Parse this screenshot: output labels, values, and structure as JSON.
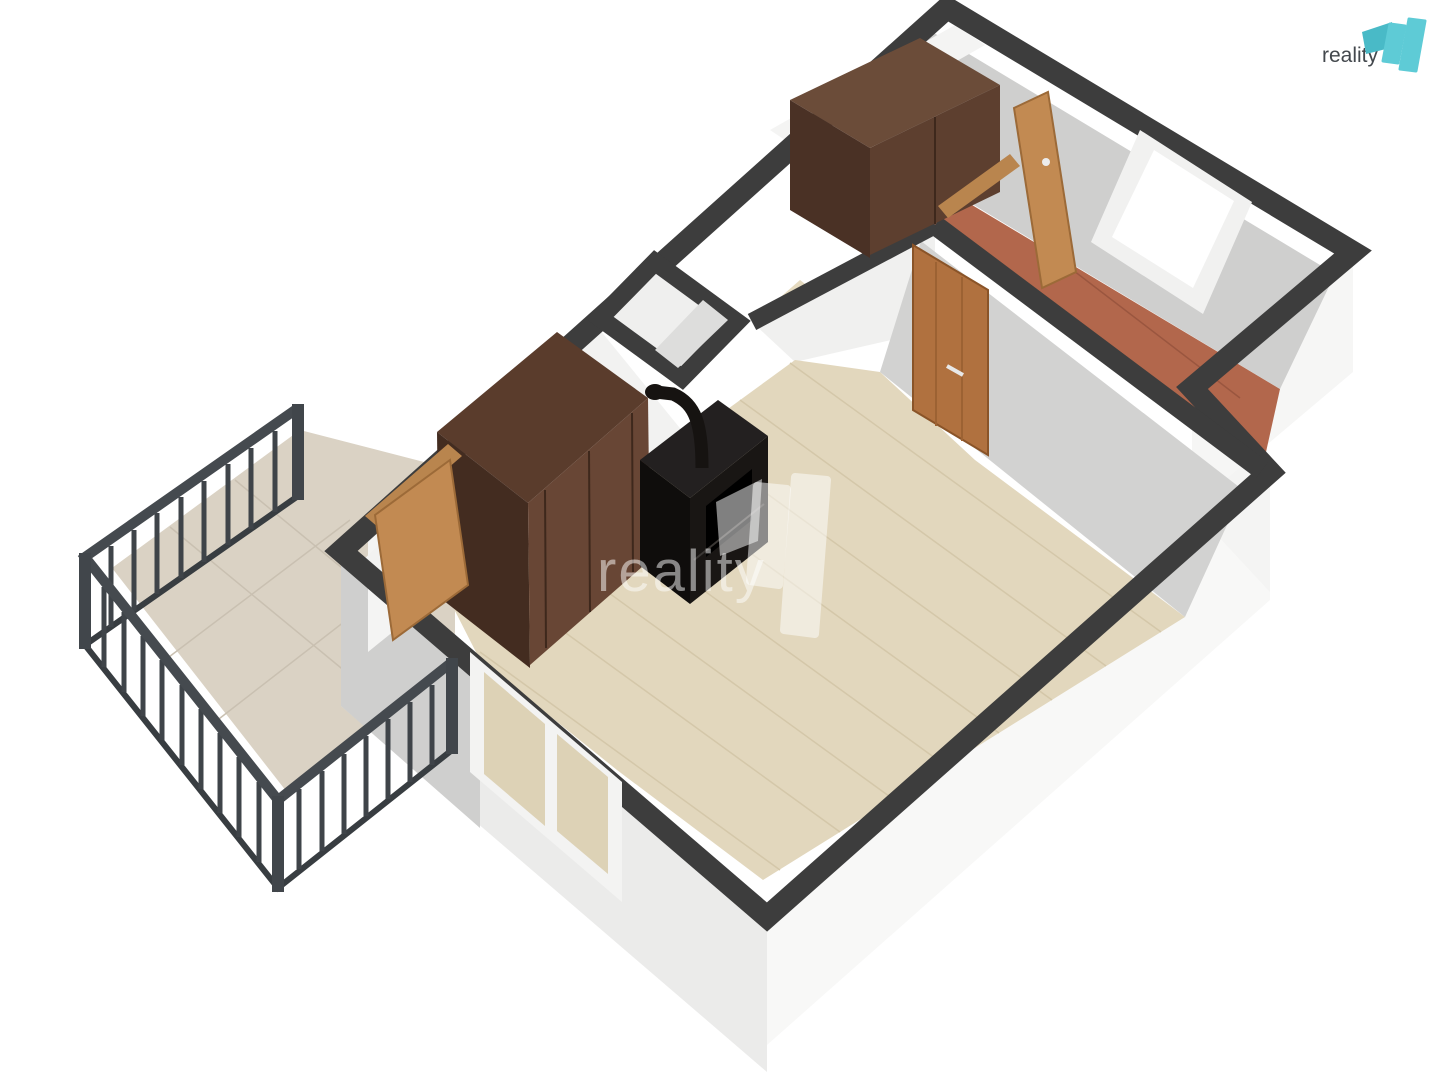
{
  "page": {
    "background": "#ffffff",
    "width": 1440,
    "height": 1080
  },
  "logo": {
    "text": "reality",
    "text_color": "#43484d",
    "teal": "#5ecbd6",
    "teal_dark": "#49bac7"
  },
  "watermark": {
    "text": "reality",
    "color": "#ffffff",
    "opacity": 0.5
  },
  "palette": {
    "wall_top": "#3d3d3d",
    "wall_int_bright": "#f2f2f1",
    "wall_int_gray": "#d2d2d1",
    "ext_white": "#f8f8f7",
    "ext_gray": "#cfcfce",
    "floor_wood": "#e2d7bd",
    "floor_terracotta": "#b2674c",
    "balcony_tile": "#dad2c4",
    "railing": "#42474b",
    "wardrobe": "#5d3f2f",
    "stove": "#161311",
    "door_wood": "#c28a52",
    "window_frame": "#f3f3f2"
  },
  "scene": {
    "width": 1440,
    "height": 1080,
    "layers": [
      {
        "name": "balcony-floor",
        "type": "polygon",
        "fill": "#dad2c4",
        "points": "300,430 112,568 290,796 455,664 455,470"
      },
      {
        "name": "balcony-tile-line",
        "type": "lines",
        "stroke": "#c9c0b1",
        "width": 1.5,
        "segments": [
          [
            170,
            527,
            352,
            677
          ],
          [
            235,
            480,
            415,
            628
          ],
          [
            165,
            660,
            350,
            520
          ],
          [
            215,
            722,
            398,
            580
          ]
        ]
      },
      {
        "name": "exterior-wall-sw",
        "type": "polygon",
        "fill": "#ebebea",
        "points": "341,551 767,917 767,1072 341,706"
      },
      {
        "name": "exterior-wall-sw-shade",
        "type": "polygon",
        "fill": "#cfcfce",
        "points": "341,551 480,670 480,828 341,706"
      },
      {
        "name": "exterior-wall-se",
        "type": "polygon",
        "fill": "#f8f8f7",
        "points": "767,917 1270,472 1270,600 767,1045"
      },
      {
        "name": "exterior-wall-step",
        "type": "polygon",
        "fill": "#f4f4f3",
        "points": "1192,388 1270,472 1270,592 1192,508"
      },
      {
        "name": "exterior-wall-rightroom",
        "type": "polygon",
        "fill": "#f6f6f5",
        "points": "1353,252 1192,388 1192,508 1353,372"
      },
      {
        "name": "exterior-stub-balcony-door",
        "type": "polygon",
        "fill": "#f4f4f3",
        "points": "452,462 368,530 368,652 452,584"
      },
      {
        "name": "hall-floor",
        "type": "polygon",
        "fill": "#b2674c",
        "points": "880,150 1280,389 1262,470 932,228"
      },
      {
        "name": "hall-tile-line",
        "type": "lines",
        "stroke": "#9a563f",
        "width": 1.5,
        "segments": [
          [
            1010,
            222,
            1240,
            398
          ],
          [
            1075,
            175,
            1278,
            330
          ]
        ]
      },
      {
        "name": "ne-wall-interior-face",
        "type": "polygon",
        "fill": "#cfcfce",
        "points": "929,30 1335,274 1280,389 874,145"
      },
      {
        "name": "bedroom-nw-wall-face",
        "type": "polygon",
        "fill": "#f4f4f3",
        "points": "770,130 955,25 985,45 800,150"
      },
      {
        "name": "bedroom-floor",
        "type": "polygon",
        "fill": "#e5dabf",
        "points": "752,322 800,352 845,315 800,280"
      },
      {
        "name": "bedroom-se-wall-face",
        "type": "polygon",
        "fill": "#f0f0ef",
        "points": "752,322 935,225 935,330 795,362"
      },
      {
        "name": "main-room-floor",
        "type": "polygon",
        "fill": "#e2d7bd",
        "points": "452,605 560,523 688,438 795,360 880,372 975,460 1113,563 1185,617 763,880 617,770 480,660"
      },
      {
        "name": "floor-plank-line",
        "type": "lines",
        "stroke": "#d4c7a9",
        "width": 1.5,
        "segments": [
          [
            480,
            652,
            780,
            870
          ],
          [
            490,
            578,
            840,
            832
          ],
          [
            540,
            543,
            893,
            799
          ],
          [
            590,
            508,
            946,
            766
          ],
          [
            640,
            473,
            999,
            733
          ],
          [
            690,
            438,
            1052,
            700
          ],
          [
            740,
            400,
            1106,
            666
          ],
          [
            790,
            363,
            1161,
            632
          ]
        ]
      },
      {
        "name": "nw-wall-interior-face",
        "type": "polygon",
        "fill": "#f2f2f1",
        "points": "357,566 600,330 688,438 452,605"
      },
      {
        "name": "mainhall-wall-face",
        "type": "polygon",
        "fill": "#d2d2d1",
        "points": "921,241 1243,490 1185,617 880,372"
      },
      {
        "name": "wall-top-perimeter",
        "type": "path",
        "stroke": "#3d3d3d",
        "width": 22,
        "fill": "none",
        "d": "M341,551 L947,8 L1353,252 L1192,388 L1270,472 L767,917 Z"
      },
      {
        "name": "wall-top-mainhall",
        "type": "lines",
        "stroke": "#3d3d3d",
        "width": 20,
        "segments": [
          [
            935,
            225,
            1262,
            470
          ]
        ]
      },
      {
        "name": "wall-top-bedroom-se",
        "type": "lines",
        "stroke": "#3d3d3d",
        "width": 18,
        "segments": [
          [
            752,
            322,
            935,
            225
          ]
        ]
      },
      {
        "name": "chimney-niche-ring",
        "type": "path",
        "stroke": "#3d3d3d",
        "width": 18,
        "fill": "#efefee",
        "d": "M600,318 L655,262 L737,322 L682,378 Z"
      },
      {
        "name": "chimney-niche-shade",
        "type": "polygon",
        "fill": "#dddddc",
        "points": "655,350 703,300 728,320 678,368"
      },
      {
        "name": "window-sw-frame",
        "type": "polygon",
        "fill": "#f3f3f2",
        "points": "470,652 622,782 622,902 470,772"
      },
      {
        "name": "window-sw-glass-left",
        "type": "polygon",
        "fill": "#ddd2b6",
        "points": "484,672 545,724 545,826 484,774"
      },
      {
        "name": "window-sw-glass-right",
        "type": "polygon",
        "fill": "#ddd2b6",
        "points": "557,734 608,777 608,874 557,831"
      },
      {
        "name": "window-ne-frame",
        "type": "polygon",
        "fill": "#f1f1f0",
        "points": "1140,130 1252,202 1203,314 1091,242"
      },
      {
        "name": "window-ne-glass",
        "type": "polygon",
        "fill": "#ffffff",
        "points": "1154,150 1234,201 1193,288 1112,237"
      },
      {
        "name": "wardrobe-livingroom-top",
        "type": "polygon",
        "fill": "#5a3c2c",
        "points": "437,432 557,332 648,398 528,503"
      },
      {
        "name": "wardrobe-livingroom-side",
        "type": "polygon",
        "fill": "#432c20",
        "points": "437,432 528,503 530,668 439,597"
      },
      {
        "name": "wardrobe-livingroom-front",
        "type": "polygon",
        "fill": "#684635",
        "points": "528,503 648,398 650,560 530,665"
      },
      {
        "name": "wardrobe-livingroom-doorline",
        "type": "lines",
        "stroke": "#3e281c",
        "width": 2,
        "segments": [
          [
            589,
            451,
            590,
            612
          ],
          [
            545,
            490,
            546,
            648
          ],
          [
            632,
            413,
            633,
            572
          ]
        ]
      },
      {
        "name": "stove-side",
        "type": "polygon",
        "fill": "#0f0d0c",
        "points": "640,460 690,498 690,604 640,566"
      },
      {
        "name": "stove-front",
        "type": "polygon",
        "fill": "#191614",
        "points": "690,498 768,436 768,542 690,604"
      },
      {
        "name": "stove-top",
        "type": "polygon",
        "fill": "#232020",
        "points": "640,460 718,400 768,436 690,498"
      },
      {
        "name": "stove-door",
        "type": "polygon",
        "fill": "#000000",
        "points": "706,506 752,469 752,520 706,557"
      },
      {
        "name": "stove-highlight",
        "type": "lines",
        "stroke": "#3a3734",
        "width": 2,
        "segments": [
          [
            694,
            560,
            764,
            504
          ]
        ]
      },
      {
        "name": "stove-pipe",
        "type": "path",
        "stroke": "#161311",
        "width": 13,
        "fill": "none",
        "d": "M702,468 C702,425 696,404 673,394 L656,392"
      },
      {
        "name": "stove-pipe-flange",
        "type": "ellipse",
        "fill": "#161311",
        "cx": 655,
        "cy": 392,
        "rx": 10,
        "ry": 8
      },
      {
        "name": "wardrobe-bedroom-top",
        "type": "polygon",
        "fill": "#6b4c39",
        "points": "790,100 920,38 1000,85 870,148"
      },
      {
        "name": "wardrobe-bedroom-side",
        "type": "polygon",
        "fill": "#4a3125",
        "points": "790,100 870,148 870,258 790,210"
      },
      {
        "name": "wardrobe-bedroom-front",
        "type": "polygon",
        "fill": "#5d3f2f",
        "points": "870,148 1000,85 1000,192 870,255"
      },
      {
        "name": "wardrobe-bedroom-doorline",
        "type": "lines",
        "stroke": "#3e281c",
        "width": 2,
        "segments": [
          [
            935,
            117,
            935,
            224
          ]
        ]
      },
      {
        "name": "balcony-door-lintel",
        "type": "polygon",
        "fill": "#b9854e",
        "points": "365,516 448,444 462,456 379,528"
      },
      {
        "name": "balcony-door-leaf",
        "type": "polygon",
        "fill": "#c28a52",
        "stroke": "#9c6a38",
        "width": 2,
        "points": "375,515 450,460 468,585 393,640"
      },
      {
        "name": "door-livingroom-hall",
        "type": "polygon",
        "fill": "#b0713f",
        "stroke": "#8a5428",
        "width": 2,
        "points": "913,245 988,290 988,455 913,410"
      },
      {
        "name": "door-livingroom-hall-grooves",
        "type": "lines",
        "stroke": "#9c6233",
        "width": 2,
        "segments": [
          [
            936,
            262,
            936,
            426
          ],
          [
            962,
            277,
            962,
            441
          ]
        ]
      },
      {
        "name": "door-livingroom-hall-handle",
        "type": "lines",
        "stroke": "#e8e8e8",
        "width": 4,
        "segments": [
          [
            947,
            366,
            963,
            375
          ]
        ]
      },
      {
        "name": "bedroom-door-lintel",
        "type": "polygon",
        "fill": "#b9854e",
        "points": "938,206 1010,154 1020,166 948,218"
      },
      {
        "name": "bedroom-door-leaf",
        "type": "polygon",
        "fill": "#c28a52",
        "stroke": "#9c6a38",
        "width": 2,
        "points": "1014,108 1048,92 1076,272 1042,288"
      },
      {
        "name": "bedroom-door-handle",
        "type": "ellipse",
        "fill": "#ececec",
        "cx": 1046,
        "cy": 162,
        "rx": 4,
        "ry": 4
      },
      {
        "name": "railing-bottom-rail",
        "type": "path",
        "stroke": "#383d41",
        "width": 6,
        "fill": "none",
        "d": "M298,496 L85,645 L278,888 L452,750"
      },
      {
        "name": "railing-balusters",
        "type": "lines",
        "stroke": "#3f4449",
        "width": 5,
        "segments": [
          [
            275,
            431,
            275,
            512
          ],
          [
            251,
            448,
            251,
            529
          ],
          [
            228,
            464,
            228,
            545
          ],
          [
            204,
            481,
            204,
            562
          ],
          [
            181,
            497,
            181,
            578
          ],
          [
            157,
            513,
            157,
            594
          ],
          [
            134,
            530,
            134,
            611
          ],
          [
            111,
            546,
            111,
            627
          ],
          [
            104,
            587,
            104,
            667
          ],
          [
            124,
            612,
            124,
            692
          ],
          [
            143,
            636,
            143,
            716
          ],
          [
            162,
            660,
            162,
            740
          ],
          [
            182,
            685,
            182,
            765
          ],
          [
            201,
            709,
            201,
            789
          ],
          [
            220,
            733,
            220,
            813
          ],
          [
            239,
            757,
            239,
            837
          ],
          [
            259,
            782,
            259,
            862
          ],
          [
            299,
            789,
            299,
            869
          ],
          [
            322,
            771,
            322,
            851
          ],
          [
            344,
            754,
            344,
            834
          ],
          [
            366,
            736,
            366,
            816
          ],
          [
            388,
            719,
            388,
            799
          ],
          [
            410,
            702,
            410,
            782
          ],
          [
            432,
            685,
            432,
            765
          ]
        ]
      },
      {
        "name": "railing-top-rail",
        "type": "path",
        "stroke": "#454a4f",
        "width": 10,
        "fill": "none",
        "d": "M298,408 L85,557 L278,800 L452,662"
      },
      {
        "name": "railing-posts",
        "type": "lines",
        "stroke": "#41464b",
        "width": 12,
        "segments": [
          [
            298,
            404,
            298,
            500
          ],
          [
            85,
            553,
            85,
            649
          ],
          [
            278,
            796,
            278,
            892
          ],
          [
            452,
            658,
            452,
            754
          ]
        ]
      },
      {
        "name": "watermark-text",
        "type": "text",
        "bind": "watermark.text",
        "x": 597,
        "y": 591,
        "size": 58,
        "fill": "#ffffff",
        "opacity": 0.5,
        "anchor": "start",
        "spacing": 2
      },
      {
        "name": "watermark-glyph-flag",
        "type": "polygon",
        "fill": "#ffffff",
        "opacity": 0.5,
        "points": "716,502 762,479 758,541 720,556"
      },
      {
        "name": "watermark-glyph-bar1",
        "type": "polygon",
        "fill": "#ffffff",
        "opacity": 0.5,
        "stroke": "#ffffff",
        "width": 8,
        "linejoin": "round",
        "points": "757,486 787,489 779,585 750,581"
      },
      {
        "name": "watermark-glyph-bar2",
        "type": "polygon",
        "fill": "#ffffff",
        "opacity": 0.5,
        "stroke": "#ffffff",
        "width": 8,
        "linejoin": "round",
        "points": "795,477 827,480 815,634 784,630"
      },
      {
        "name": "logo-text",
        "type": "text",
        "bind": "logo.text",
        "x": 1378,
        "y": 62,
        "size": 21,
        "fill": "#43484d",
        "opacity": 1,
        "anchor": "end",
        "spacing": 0
      },
      {
        "name": "logo-glyph-flag",
        "type": "polygon",
        "fill": "#49bac7",
        "opacity": 1,
        "points": "1362,32 1392,22 1390,48 1366,54"
      },
      {
        "name": "logo-glyph-bar1",
        "type": "polygon",
        "fill": "#5ecbd6",
        "opacity": 1,
        "stroke": "#5ecbd6",
        "width": 3,
        "linejoin": "round",
        "points": "1390,24 1405,26 1398,63 1383,61"
      },
      {
        "name": "logo-glyph-bar2",
        "type": "polygon",
        "fill": "#5ecbd6",
        "opacity": 1,
        "stroke": "#5ecbd6",
        "width": 3,
        "linejoin": "round",
        "points": "1409,19 1425,21 1416,71 1400,69"
      }
    ]
  }
}
